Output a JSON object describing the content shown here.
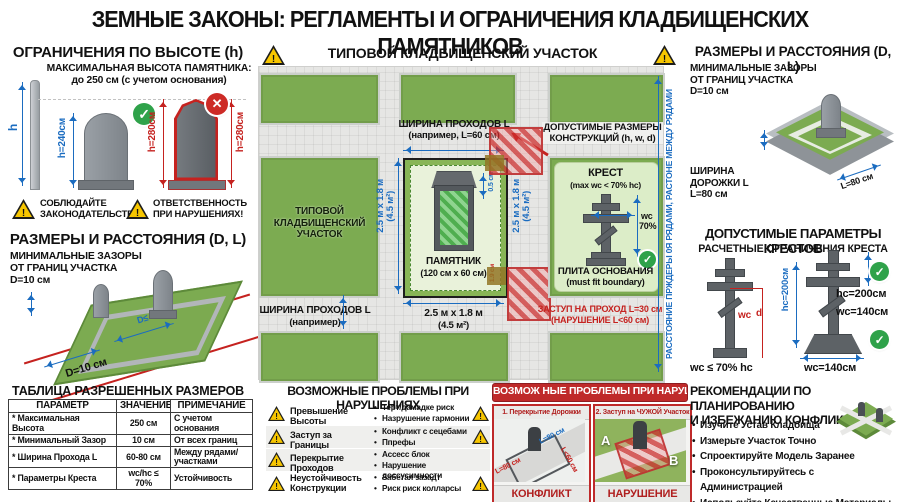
{
  "title": "ЗЕМНЫЕ ЗАКОНЫ: РЕГЛАМЕНТЫ И ОГРАНИЧЕНИЯ КЛАДБИЩЕНСКИХ ПАМЯТНИКОВ",
  "icons": {
    "warning": "!",
    "check": "✓",
    "cross": "✕"
  },
  "colors": {
    "blue": "#1b6cc0",
    "red": "#c5221f",
    "grass": "#7cab51",
    "warning_yellow": "#f7c600",
    "ok_green": "#2fa24a",
    "panel_red": "#bf2a2a"
  },
  "left": {
    "height": {
      "title": "ОГРАНИЧЕНИЯ ПО ВЫСОТЕ (h)",
      "subtitle": "МАКСИМАЛЬНАЯ ВЫСОТА ПАМЯТНИКА:",
      "limit": "до 250 см (с учетом основания)",
      "pole_label": "h",
      "ok_height": "h=240см",
      "bad_height_left": "h=280см",
      "bad_height_right": "h=280см",
      "warning1_line1": "СОБЛЮДАЙТЕ",
      "warning1_line2": "ЗАКОНОДАТЕЛЬСТВО!",
      "warning2_line1": "ОТВЕТСТВЕННОСТЬ",
      "warning2_line2": "ПРИ НАРУШЕНИЯХ!"
    },
    "sizes": {
      "title": "РАЗМЕРЫ И РАССТОЯНИЯ (D, L)",
      "note_line1": "МИНИМАЛЬНЫЕ ЗАЗОРЫ",
      "note_line2": "ОТ ГРАНИЦ УЧАСТКА",
      "note_line3": "D=10 см",
      "dim_label": "D=10 см",
      "inner_label": "D≤"
    },
    "table": {
      "title": "ТАБЛИЦА РАЗРЕШЕННЫХ РАЗМЕРОВ",
      "headers": [
        "ПАРАМЕТР",
        "ЗНАЧЕНИЕ",
        "ПРИМЕЧАНИЕ"
      ],
      "rows": [
        [
          "* Максимальная Высота",
          "250 см",
          "С учетом основания"
        ],
        [
          "* Минимальный Зазор",
          "10 см",
          "От всех границ"
        ],
        [
          "* Ширина Прохода L",
          "60-80 см",
          "Между рядами/участками"
        ],
        [
          "* Параметры Креста",
          "wc/hc ≤ 70%",
          "Устойчивость"
        ]
      ]
    }
  },
  "center": {
    "plan": {
      "title": "ТИПОВОЙ КЛАДБИЩЕНСКИЙ УЧАСТОК",
      "plot_label_line1": "ТИПОВОЙ",
      "plot_label_line2": "КЛАДБИЩЕНСКИЙ",
      "plot_label_line3": "УЧАСТОК",
      "passage_top_line1": "ШИРИНА ПРОХОДОВ L",
      "passage_top_line2": "(например, L=60 см)",
      "passage_bottom_line1": "ШИРИНА ПРОХОДОВ L",
      "passage_bottom_line2": "(например)",
      "plot_dim_left": "2.5 м x 1.8 м\n(4.5 м²)",
      "plot_dim_right": "2.5 м x 1.8 м\n(4.5 м²)",
      "plot_dim_bottom_line1": "2.5 м x 1.8 м",
      "plot_dim_bottom_line2": "(4.5 м²)",
      "monument_line1": "ПАМЯТНИК",
      "monument_line2": "(120 см x 60 см)",
      "monument_dim_small": "0.5 см",
      "monument_dim_red": "1.9 см",
      "allowed_line1": "ДОПУСТИМЫЕ РАЗМЕРЫ",
      "allowed_line2": "КОНСТРУКЦИЙ (h, w, d)",
      "cross_title": "КРЕСТ",
      "cross_sub": "(max wc < 70% hc)",
      "cross_w_label": "wc",
      "cross_w_pct": "70%",
      "base_line1": "ПЛИТА ОСНОВАНИЯ",
      "base_line2": "(must fit boundary)",
      "violation_line1": "ЗАСТУП НА ПРОХОД L=30 см",
      "violation_line2": "(НАРУШЕНИЕ L<60 см)",
      "side_label": "РАССТОЯНИЕ ПРЖДЕРЫ 0Я РЯДАМИ, РАСТОНЕ МЕЖДУ РЯДАМИ"
    },
    "problems": {
      "title": "ВОЗМОЖНЫЕ ПРОБЛЕМЫ ПРИ НАРУШЕНИЯХ",
      "rows": [
        {
          "label": "Превышение Высоты",
          "b1": "Терт/дамадке риск",
          "b2": "Назрушение гармонии"
        },
        {
          "label": "Заступ за Границы",
          "b1": "Конфликт с сецебами",
          "b2": "Ппрефы"
        },
        {
          "label": "Перекрытие Проходов",
          "b1": "Ассесс блок",
          "b2": "Нарушение доссусимности"
        },
        {
          "label": "Неустойчивость Конструкции",
          "b1": "Забетая зазадт",
          "b2": "Риск риск колларсы"
        }
      ]
    },
    "red_problems": {
      "title": "ВОЗМОЖ НЫЕ ПРОБЛЕМЫ ПРИ НАРУШЕНИХ",
      "panel1": {
        "title": "1. Перекрытие Дорожки",
        "label_blue": "L=80 см",
        "label_red1": "L=80 см",
        "label_red2": "L<60 см",
        "caption": "КОНФЛИКТ"
      },
      "panel2": {
        "title": "2. Заступ на ЧУЖОЙ Участок",
        "label_a": "A",
        "label_b": "B",
        "caption": "НАРУШЕНИЕ"
      }
    }
  },
  "right": {
    "sizes": {
      "title": "РАЗМЕРЫ И РАССТОЯНИЯ (D, L)",
      "note_line1": "МИНИМАЛЬНЫЕ ЗАЗОРЫ",
      "note_line2": "ОТ ГРАНИЦ УЧАСТКА",
      "note_line3": "D=10 см",
      "path_line1": "ШИРИНА",
      "path_line2": "ДОРОЖКИ L",
      "path_line3": "L=80 см",
      "iso_label": "L=80 см"
    },
    "crosses": {
      "title": "ДОПУСТИМЫЕ ПАРАМЕТРЫ КРЕСТОВ",
      "subtitle": "РАСЧЕТНЫЕ ОГРАНИЧЕНИЯ КРЕСТА",
      "left_w": "wc",
      "left_d": "d",
      "left_formula": "wc ≤ 70% hc",
      "right_h_vertical": "hc=200см",
      "right_h": "hc=200см",
      "right_w": "wc=140см",
      "right_w_bottom": "wc=140см"
    },
    "recommendations": {
      "title_line1": "РЕКОМЕНДАЦИИ ПО ПЛАНИРОВАНИЮ",
      "title_line2": "И ИЗБЕЖАНИЮ КОНФЛИКТОВ",
      "items": [
        "Изучите Устав Кладбища",
        "Измерьте Участок Точно",
        "Спроектируйте Модель Заранее",
        "Проконсультируйтесь с Администрацией",
        "Используйте Качественные Материалы"
      ]
    }
  }
}
